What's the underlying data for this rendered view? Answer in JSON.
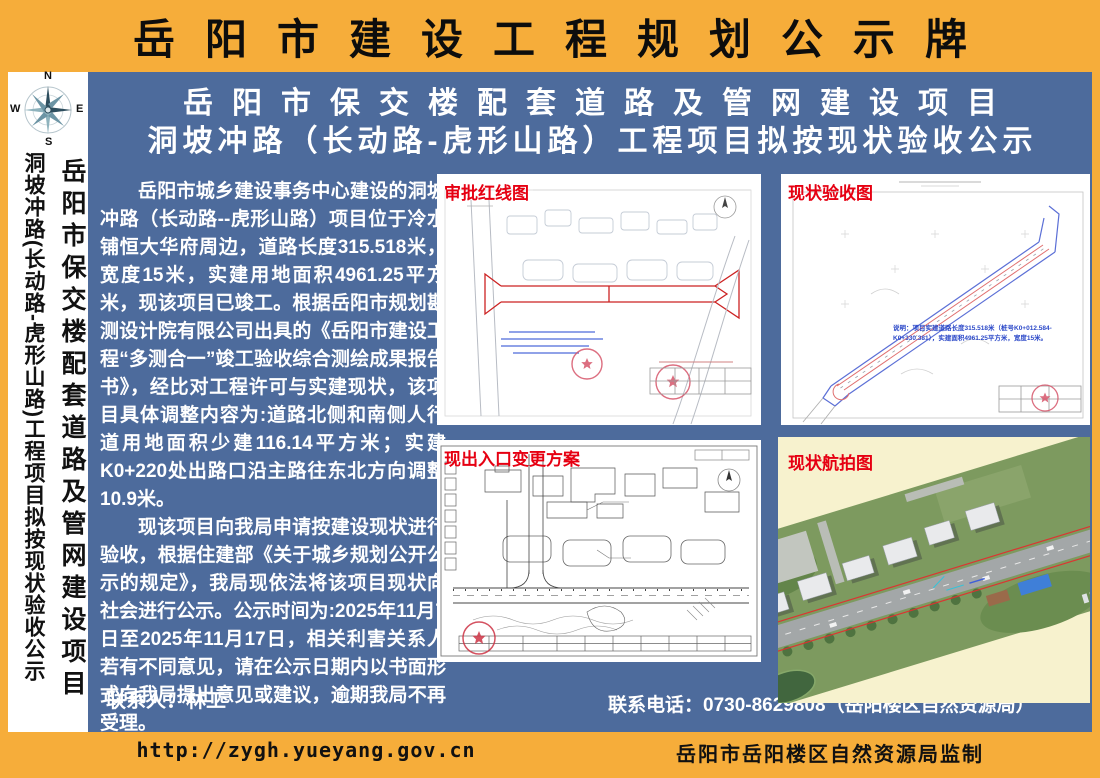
{
  "header": {
    "title": "岳阳市建设工程规划公示牌"
  },
  "sidebar": {
    "compass": {
      "n": "N",
      "e": "E",
      "s": "S",
      "w": "W"
    },
    "line1": "岳阳市保交楼配套道路及管网建设项目",
    "line2": "洞坡冲路(长动路-虎形山路)工程项目拟按现状验收公示"
  },
  "main": {
    "title_line1": "岳阳市保交楼配套道路及管网建设项目",
    "title_line2": "洞坡冲路（长动路-虎形山路）工程项目拟按现状验收公示",
    "paragraph1": "岳阳市城乡建设事务中心建设的洞坡冲路（长动路--虎形山路）项目位于冷水铺恒大华府周边，道路长度315.518米，宽度15米，实建用地面积4961.25平方米，现该项目已竣工。根据岳阳市规划勘测设计院有限公司出具的《岳阳市建设工程“多测合一”竣工验收综合测绘成果报告书》，经比对工程许可与实建现状，该项目具体调整内容为:道路北侧和南侧人行道用地面积少建116.14平方米；实建K0+220处出路口沿主路往东北方向调整10.9米。",
    "paragraph2": "现该项目向我局申请按建设现状进行验收，根据住建部《关于城乡规划公开公示的规定》，我局现依法将该项目现状向社会进行公示。公示时间为:2025年11月7日至2025年11月17日，相关利害关系人若有不同意见，请在公示日期内以书面形式向我局提出意见或建议，逾期我局不再受理。",
    "contact_person": "联系人：林工",
    "contact_phone": "联系电话：0730-8629808（岳阳楼区自然资源局）"
  },
  "panels": {
    "approval_redline": {
      "label": "审批红线图"
    },
    "current_acceptance": {
      "label": "现状验收图",
      "note": "说明：项目实建道路长度315.518米（桩号K0+012.584-K0+330.381），实建面积4961.25平方米，宽度15米。"
    },
    "entrance_change": {
      "label": "现出入口变更方案"
    },
    "aerial_photo": {
      "label": "现状航拍图"
    }
  },
  "footer": {
    "url": "http://zygh.yueyang.gov.cn",
    "credit": "岳阳市岳阳楼区自然资源局监制"
  },
  "colors": {
    "frame_orange": "#F6AD3A",
    "body_blue": "#4D6B9C",
    "label_red": "#E60012",
    "aerial_cream": "#F7F2CE",
    "redline": "#CC2222",
    "blueprint_blue": "#5B6FD6"
  }
}
